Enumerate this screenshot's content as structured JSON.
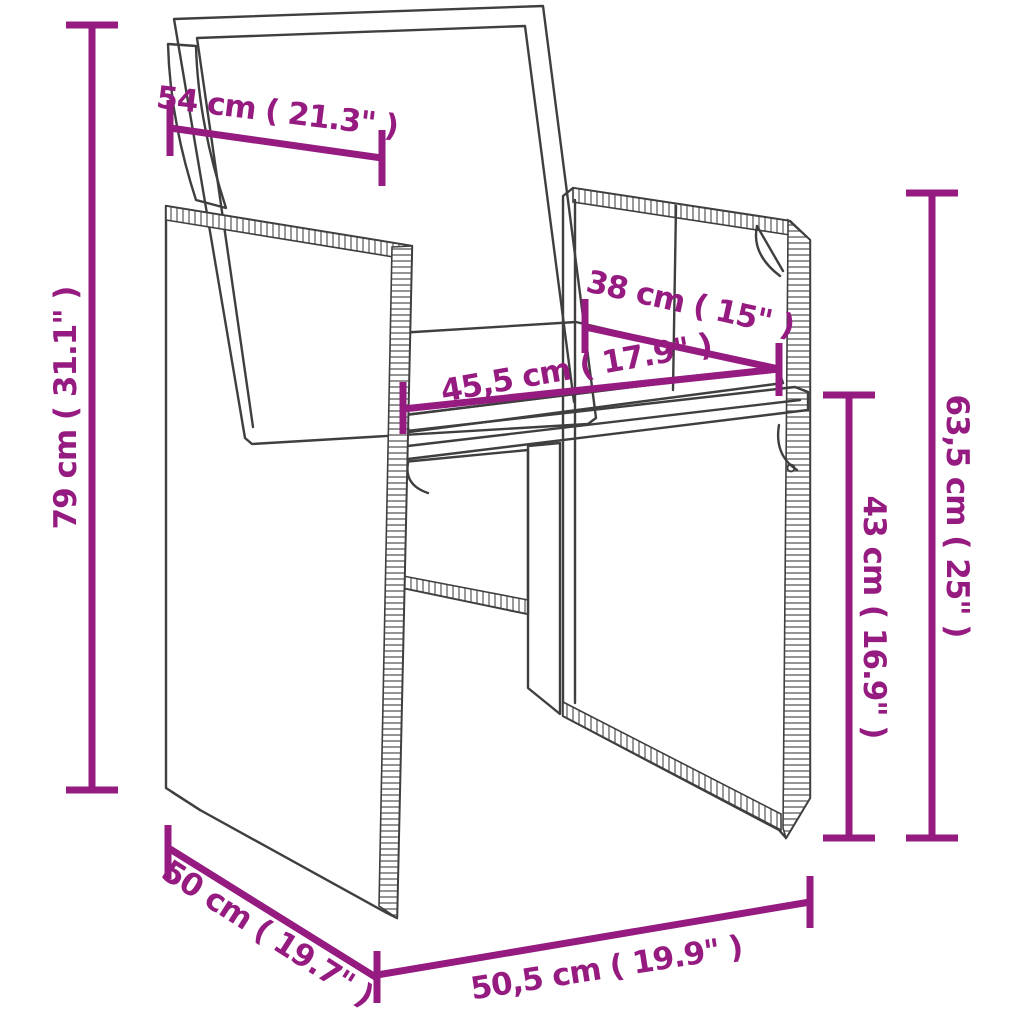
{
  "canvas": {
    "background": "#ffffff"
  },
  "style": {
    "accent_color": "#951b81",
    "line_color": "#3f3f3f",
    "weave_line_color": "#565656",
    "cushion_fill": "#ffffff"
  },
  "subject": {
    "name": "poly-rattan garden armchair with back and seat cushions",
    "view": "three-quarter perspective line drawing"
  },
  "dimensions": {
    "back_width": {
      "label": "54 cm ( 21.3\" )"
    },
    "total_height": {
      "label": "79 cm ( 31.1\" )"
    },
    "seat_depth": {
      "label": "38 cm ( 15\" )"
    },
    "seat_width": {
      "label": "45,5 cm ( 17.9\" )"
    },
    "armrest_height": {
      "label": "63,5 cm ( 25\" )"
    },
    "seat_height": {
      "label": "43 cm ( 16.9\" )"
    },
    "chair_depth": {
      "label": "50 cm ( 19.7\" )"
    },
    "chair_width": {
      "label": "50,5 cm ( 19.9\" )"
    }
  }
}
